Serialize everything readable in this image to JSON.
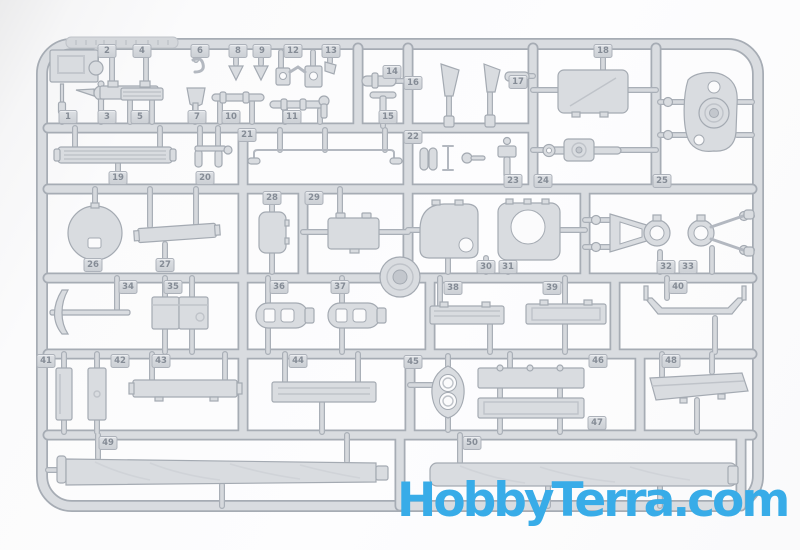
{
  "meta": {
    "description": "Product photo of an unpainted light-gray injection-molded styrene sprue (model kit parts tree) with parts numbered 1-50, including tool planks, boxes, tow frames, a mounting plate, hatch covers and two long gun-barrel halves, on a white background"
  },
  "watermark": {
    "text": "HobbyTerra.com",
    "color": "#38ACE8"
  },
  "sprue": {
    "plastic_color": "#d9dce0",
    "outline_color": "#a4aab2",
    "part_tags": [
      {
        "label": "1",
        "x": 68,
        "y": 117
      },
      {
        "label": "2",
        "x": 107,
        "y": 51
      },
      {
        "label": "3",
        "x": 107,
        "y": 117
      },
      {
        "label": "4",
        "x": 142,
        "y": 51
      },
      {
        "label": "5",
        "x": 140,
        "y": 117
      },
      {
        "label": "6",
        "x": 200,
        "y": 51
      },
      {
        "label": "7",
        "x": 197,
        "y": 117
      },
      {
        "label": "8",
        "x": 238,
        "y": 51
      },
      {
        "label": "9",
        "x": 262,
        "y": 51
      },
      {
        "label": "10",
        "x": 231,
        "y": 117
      },
      {
        "label": "11",
        "x": 292,
        "y": 117
      },
      {
        "label": "12",
        "x": 293,
        "y": 51
      },
      {
        "label": "13",
        "x": 331,
        "y": 51
      },
      {
        "label": "14",
        "x": 392,
        "y": 72
      },
      {
        "label": "15",
        "x": 388,
        "y": 117
      },
      {
        "label": "16",
        "x": 413,
        "y": 83
      },
      {
        "label": "17",
        "x": 518,
        "y": 82
      },
      {
        "label": "18",
        "x": 603,
        "y": 51
      },
      {
        "label": "19",
        "x": 118,
        "y": 178
      },
      {
        "label": "20",
        "x": 205,
        "y": 178
      },
      {
        "label": "21",
        "x": 247,
        "y": 135
      },
      {
        "label": "22",
        "x": 413,
        "y": 137
      },
      {
        "label": "23",
        "x": 513,
        "y": 181
      },
      {
        "label": "24",
        "x": 543,
        "y": 181
      },
      {
        "label": "25",
        "x": 662,
        "y": 181
      },
      {
        "label": "26",
        "x": 93,
        "y": 265
      },
      {
        "label": "27",
        "x": 165,
        "y": 265
      },
      {
        "label": "28",
        "x": 272,
        "y": 198
      },
      {
        "label": "29",
        "x": 314,
        "y": 198
      },
      {
        "label": "30",
        "x": 486,
        "y": 267
      },
      {
        "label": "31",
        "x": 508,
        "y": 267
      },
      {
        "label": "32",
        "x": 666,
        "y": 267
      },
      {
        "label": "33",
        "x": 688,
        "y": 267
      },
      {
        "label": "34",
        "x": 128,
        "y": 287
      },
      {
        "label": "35",
        "x": 173,
        "y": 287
      },
      {
        "label": "36",
        "x": 279,
        "y": 287
      },
      {
        "label": "37",
        "x": 340,
        "y": 287
      },
      {
        "label": "38",
        "x": 453,
        "y": 288
      },
      {
        "label": "39",
        "x": 552,
        "y": 288
      },
      {
        "label": "40",
        "x": 678,
        "y": 287
      },
      {
        "label": "41",
        "x": 46,
        "y": 361
      },
      {
        "label": "42",
        "x": 120,
        "y": 361
      },
      {
        "label": "43",
        "x": 161,
        "y": 361
      },
      {
        "label": "44",
        "x": 298,
        "y": 361
      },
      {
        "label": "45",
        "x": 413,
        "y": 362
      },
      {
        "label": "46",
        "x": 598,
        "y": 361
      },
      {
        "label": "47",
        "x": 597,
        "y": 423
      },
      {
        "label": "48",
        "x": 671,
        "y": 361
      },
      {
        "label": "49",
        "x": 108,
        "y": 443
      },
      {
        "label": "50",
        "x": 472,
        "y": 443
      }
    ]
  }
}
